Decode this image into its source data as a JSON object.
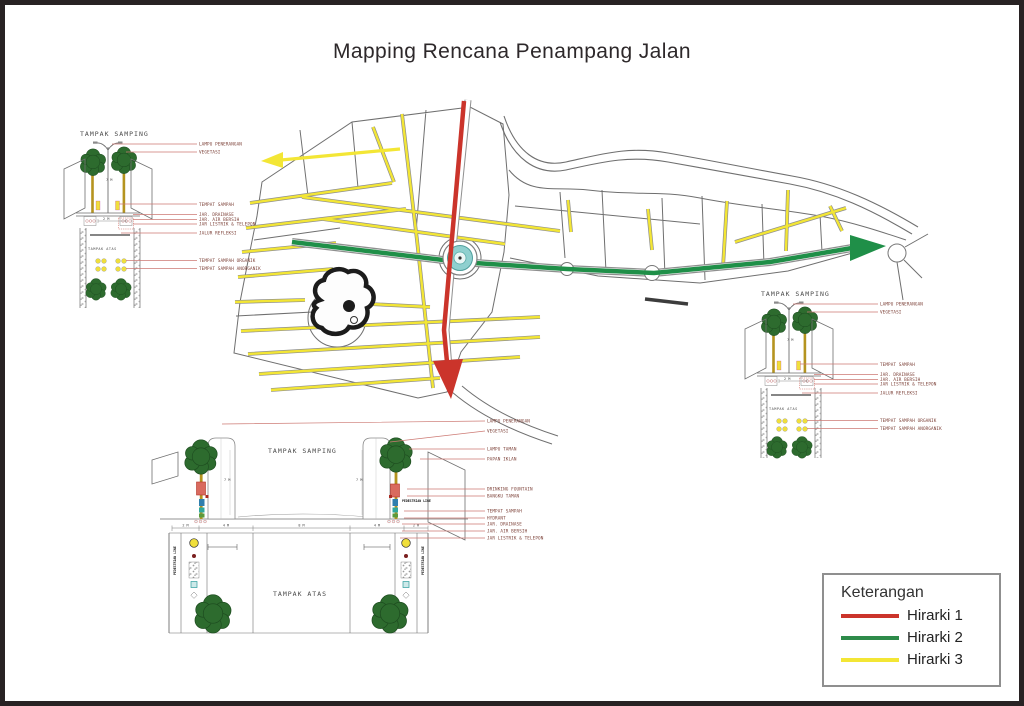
{
  "page": {
    "title": "Mapping Rencana Penampang Jalan"
  },
  "colors": {
    "hirarki1": "#cb342b",
    "hirarki2": "#1f8f48",
    "hirarki3": "#f3e635"
  },
  "legend": {
    "title": "Keterangan",
    "items": [
      {
        "label": "Hirarki 1",
        "color": "#cb342b"
      },
      {
        "label": "Hirarki 2",
        "color": "#2e8b4a"
      },
      {
        "label": "Hirarki 3",
        "color": "#f3e635"
      }
    ]
  },
  "sections": {
    "top_left": {
      "side_title": "TAMPAK SAMPING",
      "plan_title": "TAMPAK ATAS",
      "dim_height": "7 M",
      "dim_width": "2 M",
      "labels": [
        "LAMPU PENERANGAN",
        "VEGETASI",
        "TEMPAT SAMPAH",
        "JAR. DRAINASE",
        "JAR. AIR BERSIH",
        "JAR LISTRIK & TELEPON",
        "JALUR REFLEKSI",
        "TEMPAT SAMPAH ORGANIK",
        "TEMPAT SAMPAH ANORGANIK"
      ]
    },
    "bottom_center": {
      "side_title": "TAMPAK SAMPING",
      "plan_title": "TAMPAK ATAS",
      "pedestrian_label": "PEDESTRIAN LINE",
      "dim_pole": "7 M",
      "dims": [
        "2 M",
        "4 M",
        "8 M",
        "4 M",
        "2 M"
      ],
      "labels": [
        "LAMPU PENERANGAN",
        "VEGETASI",
        "LAMPU TAMAN",
        "PAPAN IKLAN",
        "DRINKING FOUNTAIN",
        "BANGKU TAMAN",
        "TEMPAT SAMPAH",
        "HYDRANT",
        "JAR. DRAINASE",
        "JAR. AIR BERSIH",
        "JAR LISTRIK & TELEPON"
      ]
    },
    "right": {
      "side_title": "TAMPAK SAMPING",
      "plan_title": "TAMPAK ATAS",
      "dim_height": "7 M",
      "dim_width": "2 M",
      "labels": [
        "LAMPU PENERANGAN",
        "VEGETASI",
        "TEMPAT SAMPAH",
        "JAR. DRAINASE",
        "JAR. AIR BERSIH",
        "JAR LISTRIK & TELEPON",
        "JALUR REFLEKSI",
        "TEMPAT SAMPAH ORGANIK",
        "TEMPAT SAMPAH ANORGANIK"
      ]
    }
  }
}
